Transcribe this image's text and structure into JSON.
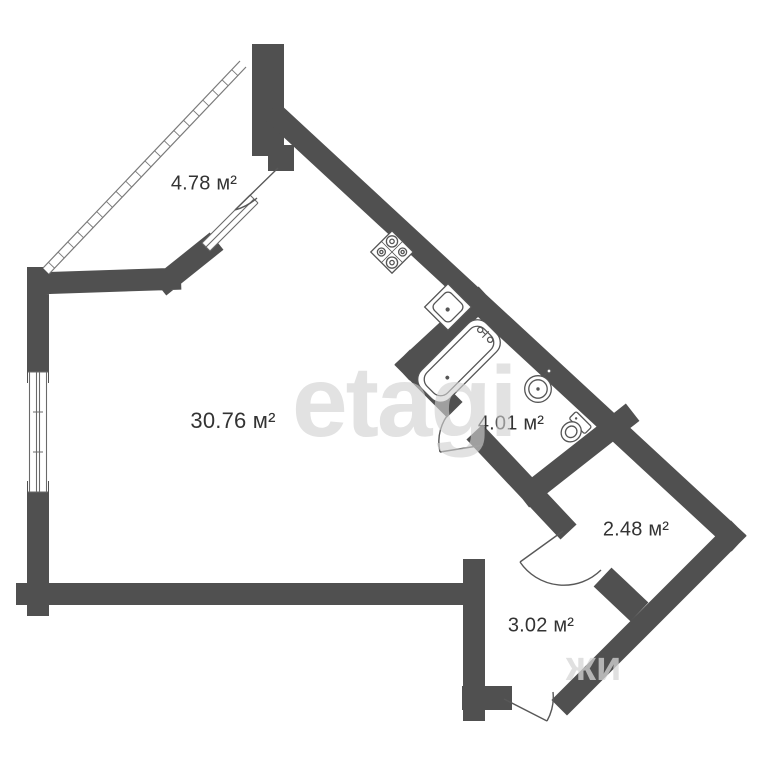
{
  "rooms": [
    {
      "name": "balcony",
      "area_label": "4.78 м²"
    },
    {
      "name": "living_kitchen",
      "area_label": "30.76 м²"
    },
    {
      "name": "bathroom",
      "area_label": "4.01 м²"
    },
    {
      "name": "closet",
      "area_label": "2.48 м²"
    },
    {
      "name": "hallway",
      "area_label": "3.02 м²"
    }
  ],
  "watermark": {
    "primary": "etagi",
    "secondary": "жи"
  },
  "fixtures": [
    {
      "name": "stove"
    },
    {
      "name": "kitchen-sink"
    },
    {
      "name": "bathtub"
    },
    {
      "name": "round-sink"
    },
    {
      "name": "toilet"
    }
  ],
  "colors": {
    "wall": "#505050",
    "fixture_outline": "#555555",
    "label_text": "#333333",
    "watermark": "#d0d0d0",
    "background": "#ffffff"
  }
}
